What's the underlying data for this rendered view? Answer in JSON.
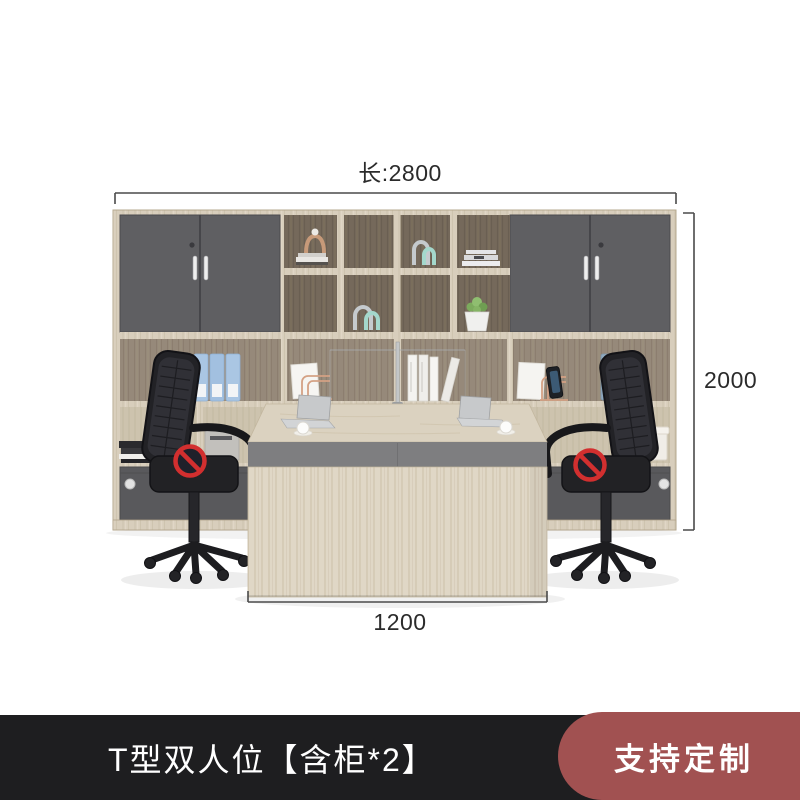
{
  "dimensions": {
    "length": {
      "label": "长:2800"
    },
    "height": {
      "label": "2000"
    },
    "depth": {
      "label": "1200"
    }
  },
  "caption": {
    "label": "T型双人位【含柜*2】"
  },
  "customize": {
    "label": "支持定制"
  },
  "product": {
    "description": "T-shaped double workstation with tall wall cabinet system, two dark grey door cabinets, open display cubbies with decor, two black mesh office chairs, light wood desk with grey band, anti-copy prohibition stamps on chairs"
  },
  "colors": {
    "caption_bar": "#1e1e20",
    "caption_text": "#ffffff",
    "badge_background": "#a15151",
    "badge_text": "#ffffff",
    "dimension_text": "#2b2b2b",
    "dimension_line": "#4a4a4a",
    "wood_light": "#d8cebc",
    "wood_dark": "#75695b",
    "door_gray": "#5f5f62",
    "desk_band_gray": "#7e7e80",
    "chair_black": "#222226",
    "binder_blue": "#aac6e3",
    "prohibition_red": "#d22f2f"
  }
}
